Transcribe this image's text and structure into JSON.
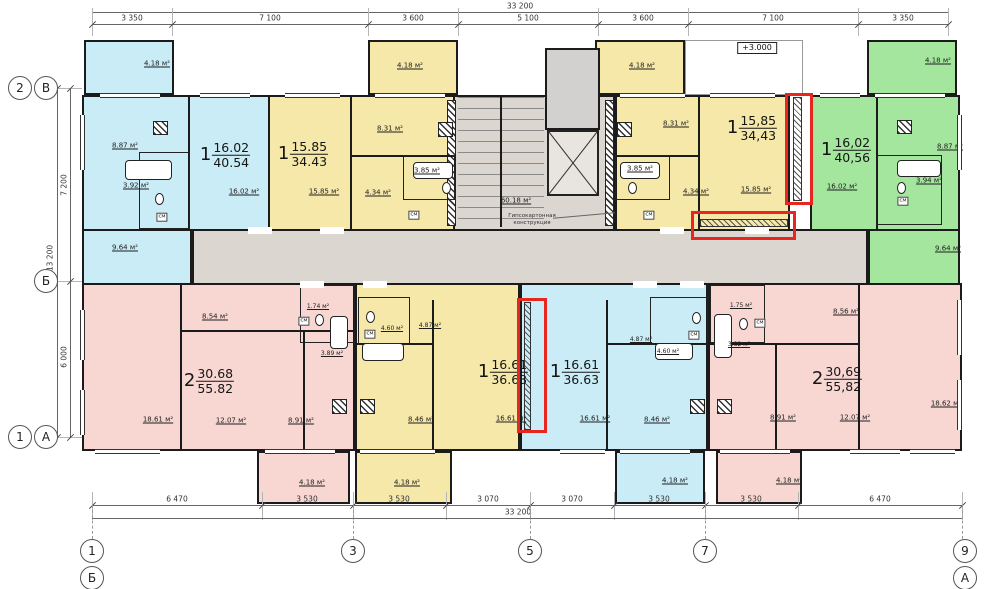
{
  "plan": {
    "elevation_mark": "+3.000",
    "corridor_area": "60.18 м²",
    "garbage_name_1": "Мусоро-",
    "garbage_name_2": "сборная",
    "garbage_name_3": "камера",
    "garbage_area": "4.25 м²",
    "drywall_note_1": "Гипсокартонная",
    "drywall_note_2": "конструкция"
  },
  "dimensions": {
    "top_overall": "33 200",
    "top_segments": [
      "3 350",
      "7 100",
      "3 600",
      "5 100",
      "3 600",
      "7 100",
      "3 350"
    ],
    "bottom_segments": [
      "6 470",
      "3 530",
      "3 530",
      "3 070",
      "3 070",
      "3 530",
      "3 530",
      "6 470"
    ],
    "bottom_overall": "33 200",
    "left_overall": "13 200",
    "left_upper": "7 200",
    "left_lower": "6 000"
  },
  "axes": {
    "left": [
      "2",
      "В",
      "Б",
      "1",
      "А"
    ],
    "bottom": [
      "1",
      "Б",
      "3",
      "5",
      "7",
      "9",
      "А"
    ]
  },
  "apartments": [
    {
      "id": "top-left-blue",
      "rooms_count": "1",
      "living_area": "16.02",
      "total_area": "40.54",
      "labels": {
        "kitchen": "8.87 м²",
        "bath": "3.92 м²",
        "living": "16.02 м²",
        "hall": "9.64 м²",
        "closet": "см",
        "balcony": "4.18 м²"
      }
    },
    {
      "id": "top-mid-left-yellow",
      "rooms_count": "1",
      "living_area": "15.85",
      "total_area": "34.43",
      "labels": {
        "kitchen": "8.31 м²",
        "bath": "3.85 м²",
        "hall": "4.34 м²",
        "living": "15.85 м²",
        "closet": "см",
        "balcony": "4.18 м²"
      }
    },
    {
      "id": "top-mid-right-yellow",
      "rooms_count": "1",
      "living_area": "15,85",
      "total_area": "34,43",
      "labels": {
        "kitchen": "8.31 м²",
        "bath": "3.85 м²",
        "hall": "4.34 м²",
        "living": "15.85 м²",
        "closet": "см",
        "balcony": "4.18 м²"
      }
    },
    {
      "id": "top-right-green",
      "rooms_count": "1",
      "living_area": "16,02",
      "total_area": "40,56",
      "labels": {
        "kitchen": "8.87 м²",
        "bath": "3.94 м²",
        "living": "16.02 м²",
        "hall": "9.64 м²",
        "closet": "см",
        "balcony": "4.18 м²"
      }
    },
    {
      "id": "bottom-left-pink",
      "rooms_count": "2",
      "living_area": "30.68",
      "total_area": "55.82",
      "labels": {
        "hall": "8.54 м²",
        "wc": "1.74 м²",
        "bath": "3.89 м²",
        "bedroom1": "18.61 м²",
        "bedroom2": "12.07 м²",
        "kitchen": "8.91 м²",
        "closet": "см",
        "balcony": "4.18 м²"
      }
    },
    {
      "id": "bottom-mid-left-yellow",
      "rooms_count": "1",
      "living_area": "16.61",
      "total_area": "36.63",
      "labels": {
        "bath": "4.60 м²",
        "hall": "4.87 м²",
        "kitchen": "8.46 м²",
        "living": "16.61 м²",
        "closet": "см",
        "balcony": "4.18 м²"
      }
    },
    {
      "id": "bottom-mid-right-blue",
      "rooms_count": "1",
      "living_area": "16.61",
      "total_area": "36.63",
      "labels": {
        "bath": "4.60 м²",
        "hall": "4.87 м²",
        "kitchen": "8.46 м²",
        "living": "16.61 м²",
        "closet": "см",
        "balcony": "4.18 м²"
      }
    },
    {
      "id": "bottom-right-pink",
      "rooms_count": "2",
      "living_area": "30,69",
      "total_area": "55,82",
      "labels": {
        "hall": "8.56 м²",
        "wc": "1.75 м²",
        "bath": "3.82 м²",
        "bedroom1": "18.62 м²",
        "bedroom2": "12.07 м²",
        "kitchen": "8.91 м²",
        "closet": "см",
        "balcony": "4.18 м²"
      }
    }
  ],
  "colors": {
    "blue": "#c9ecf7",
    "yellow": "#f6e8a9",
    "green": "#a5e69e",
    "pink": "#f8d7d3",
    "corridor": "#dcd6d0",
    "highlight_red": "#e8251f"
  }
}
